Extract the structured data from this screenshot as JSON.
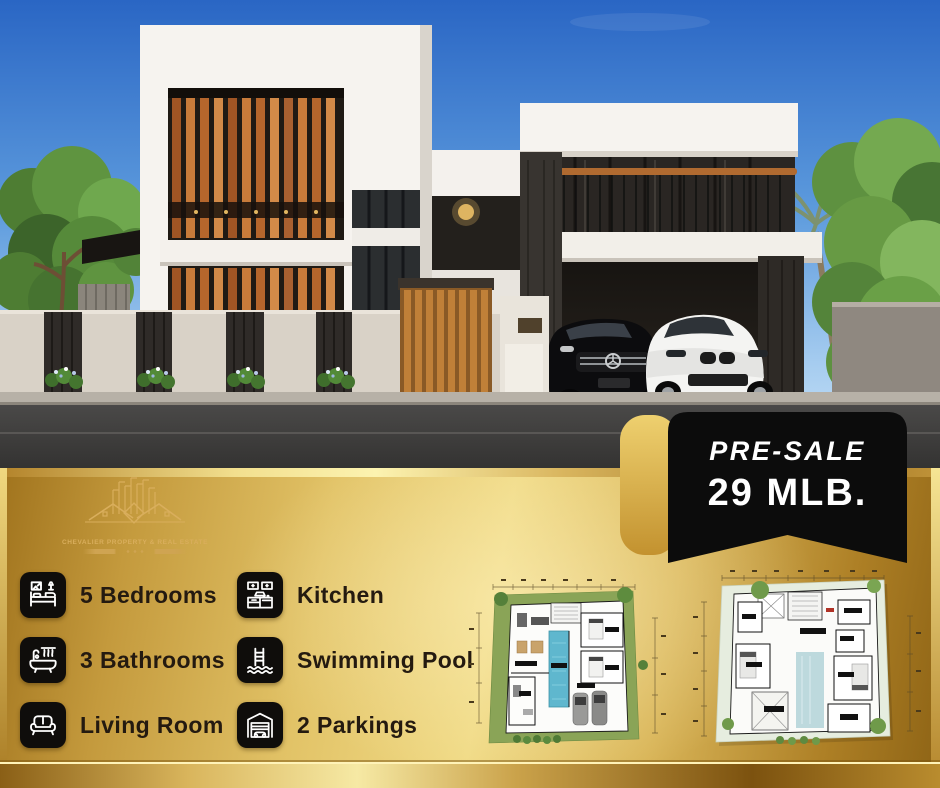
{
  "banner": {
    "presale_label": "PRE-SALE",
    "price": "29 MLB."
  },
  "logo": {
    "text": "CHEVALIER PROPERTY & REAL ESTATE"
  },
  "features": {
    "column1": [
      {
        "icon": "bed-icon",
        "label": "5 Bedrooms"
      },
      {
        "icon": "bathtub-icon",
        "label": "3 Bathrooms"
      },
      {
        "icon": "sofa-icon",
        "label": "Living Room"
      }
    ],
    "column2": [
      {
        "icon": "kitchen-icon",
        "label": "Kitchen"
      },
      {
        "icon": "pool-ladder-icon",
        "label": "Swimming Pool"
      },
      {
        "icon": "garage-icon",
        "label": "2 Parkings"
      }
    ]
  },
  "floor_plans": [
    {
      "name": "ground-floor-site-plan"
    },
    {
      "name": "upper-floor-plan"
    }
  ],
  "colors": {
    "gold_dark": "#8d6315",
    "gold_mid": "#d4a947",
    "gold_light": "#f0da85",
    "banner_bg": "#0c0c0c",
    "banner_text": "#ffffff",
    "feature_text": "#241a10",
    "tile_bg": "#0f0d0b",
    "sky_top": "#2a66c4",
    "pool_blue": "#5fb7ce"
  }
}
